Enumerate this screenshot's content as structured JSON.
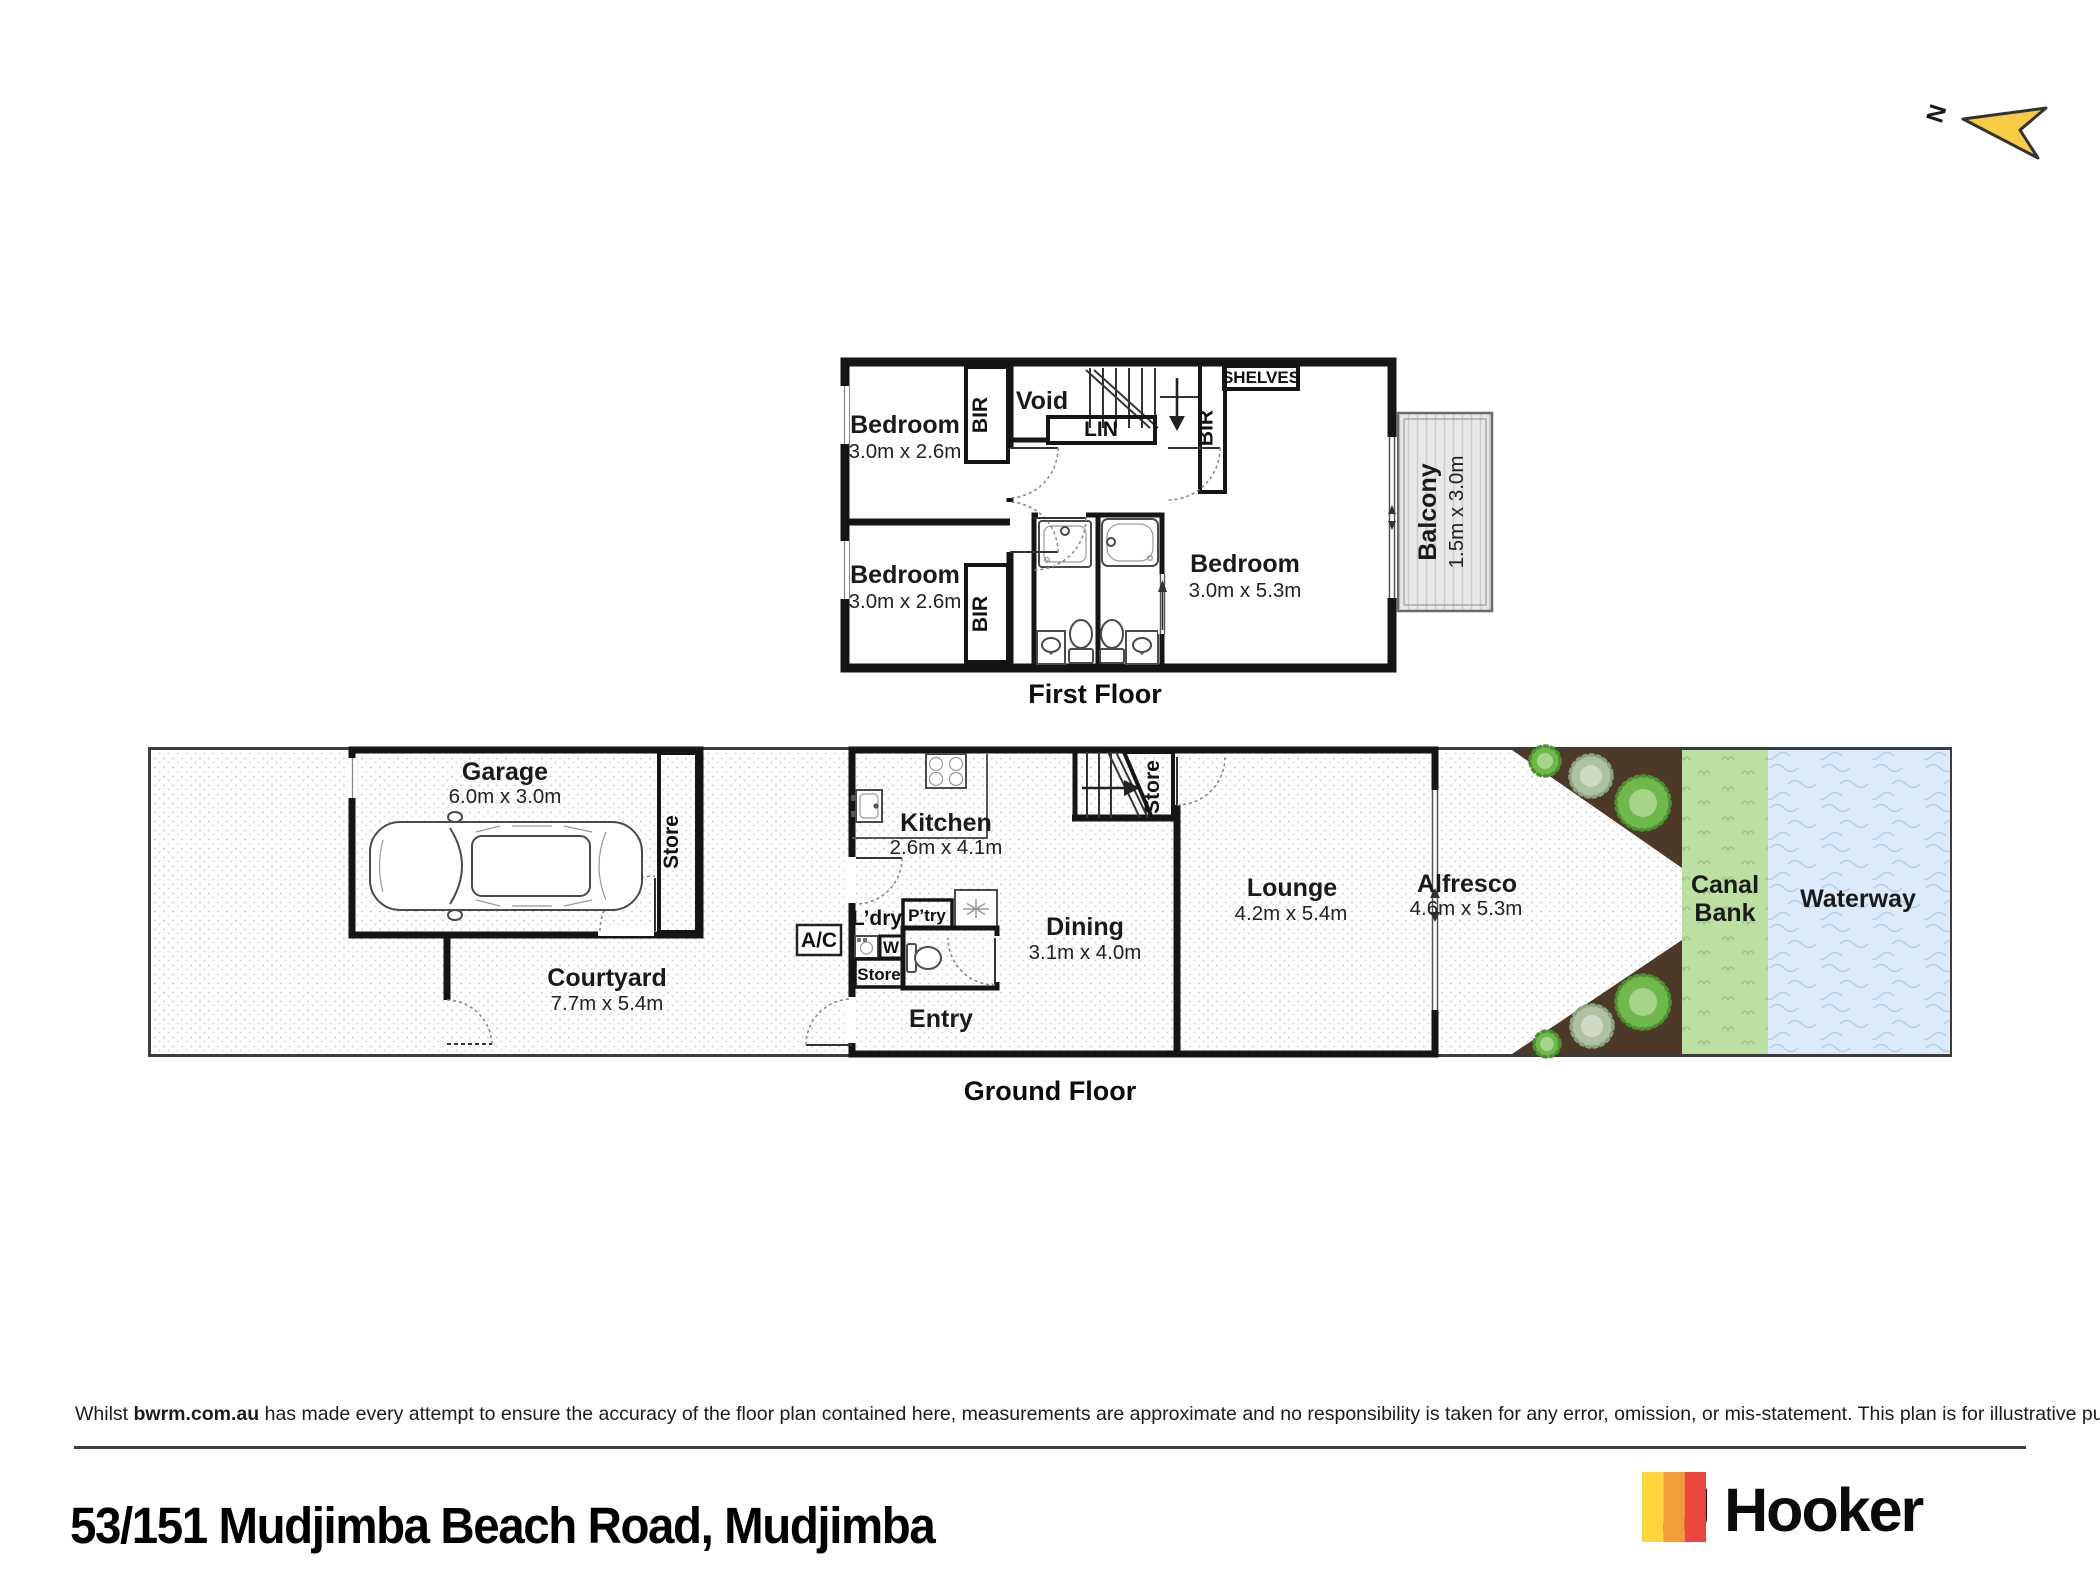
{
  "colors": {
    "yellow": "#F6CC45",
    "wall": "#151515",
    "water": "#DCEBF9",
    "canal": "#BCDFA2",
    "garden": "#4D3928",
    "logo_yellow": "#FFD43C",
    "logo_orange": "#F49B3B",
    "logo_red": "#EA463D"
  },
  "north": {
    "label": "N"
  },
  "first_floor": {
    "title": "First Floor",
    "bedroom_tl": {
      "name": "Bedroom",
      "dims": "3.0m x 2.6m"
    },
    "bedroom_bl": {
      "name": "Bedroom",
      "dims": "3.0m x 2.6m"
    },
    "bedroom_r": {
      "name": "Bedroom",
      "dims": "3.0m x 5.3m"
    },
    "void_label": "Void",
    "lin_label": "LIN",
    "shelves_label": "SHELVES",
    "bir_tl": "BIR",
    "bir_bl": "BIR",
    "bir_r": "BIR",
    "balcony": {
      "name": "Balcony",
      "dims": "1.5m x 3.0m"
    }
  },
  "ground_floor": {
    "title": "Ground Floor",
    "garage": {
      "name": "Garage",
      "dims": "6.0m x 3.0m"
    },
    "garage_store": "Store",
    "courtyard": {
      "name": "Courtyard",
      "dims": "7.7m x 5.4m"
    },
    "ac_label": "A/C",
    "kitchen": {
      "name": "Kitchen",
      "dims": "2.6m x 4.1m"
    },
    "ldry_label": "L’dry",
    "ptry_label": "P’try",
    "washer_label": "W",
    "store_label": "Store",
    "stair_store_label": "Store",
    "entry_label": "Entry",
    "dining": {
      "name": "Dining",
      "dims": "3.1m x 4.0m"
    },
    "lounge": {
      "name": "Lounge",
      "dims": "4.2m x 5.4m"
    },
    "alfresco": {
      "name": "Alfresco",
      "dims": "4.6m x 5.3m"
    },
    "canal_bank": {
      "line1": "Canal",
      "line2": "Bank"
    },
    "waterway_label": "Waterway"
  },
  "disclaimer": {
    "prefix": "Whilst ",
    "source": "bwrm.com.au",
    "body": " has made every attempt to ensure the accuracy of the floor plan contained here, measurements are approximate and no responsibility is taken for any error, omission, or mis-statement. This plan is for illustrative purposes only."
  },
  "footer": {
    "address": "53/151 Mudjimba Beach Road, Mudjimba",
    "brand": "LJ Hooker"
  }
}
